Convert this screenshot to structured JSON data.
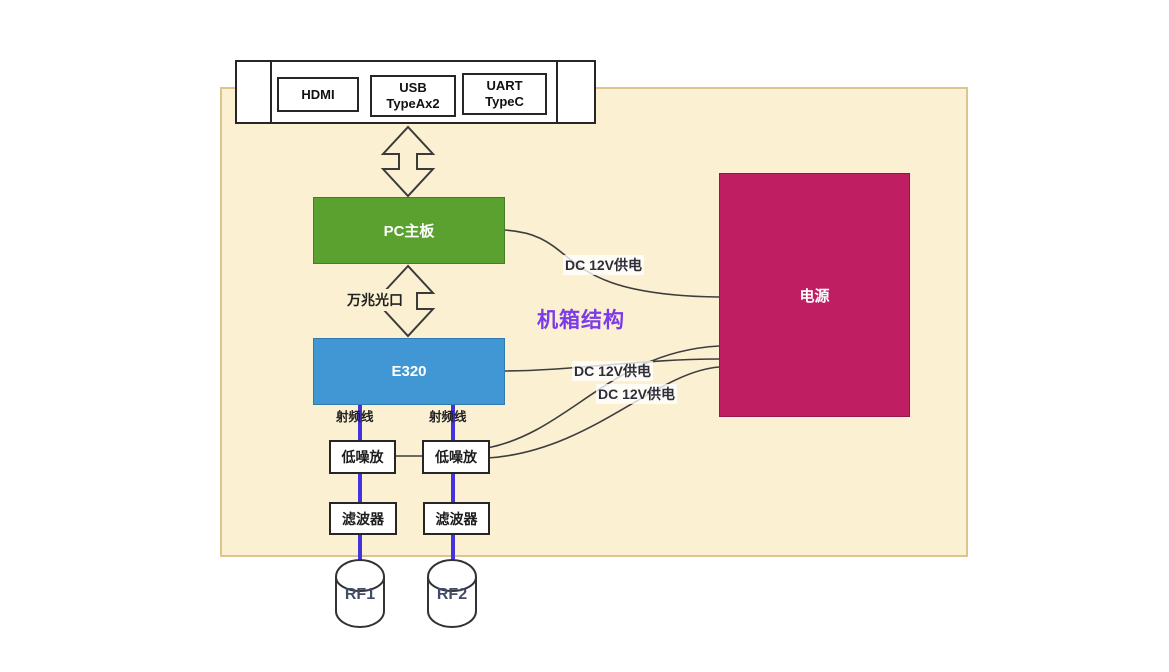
{
  "diagram": {
    "title": "机箱结构",
    "ports_bar": {
      "ports": [
        {
          "label": "HDMI"
        },
        {
          "label": "USB\nTypeAx2"
        },
        {
          "label": "UART\nTypeC"
        }
      ]
    },
    "blocks": {
      "pc_board": {
        "label": "PC主板",
        "fill": "#5AA12F"
      },
      "e320": {
        "label": "E320",
        "fill": "#4197D3"
      },
      "power": {
        "label": "电源",
        "fill": "#BF1E63"
      },
      "lna_left": {
        "label": "低噪放"
      },
      "lna_right": {
        "label": "低噪放"
      },
      "filter_left": {
        "label": "滤波器"
      },
      "filter_right": {
        "label": "滤波器"
      },
      "rf1": {
        "label": "RF1"
      },
      "rf2": {
        "label": "RF2"
      }
    },
    "labels": {
      "optical_link": "万兆光口",
      "dc_power_1": "DC 12V供电",
      "dc_power_2": "DC 12V供电",
      "dc_power_3": "DC 12V供电",
      "rf_cable_left": "射频线",
      "rf_cable_right": "射频线"
    },
    "colors": {
      "chassis_fill": "#FBF0D2",
      "chassis_border": "#DCC68E",
      "title_color": "#7B3BE8",
      "rf_line_color": "#4433DD",
      "wire_color": "#3D3D3D",
      "pc_board_fill": "#5AA12F",
      "e320_fill": "#4197D3",
      "power_fill": "#BF1E63"
    }
  }
}
